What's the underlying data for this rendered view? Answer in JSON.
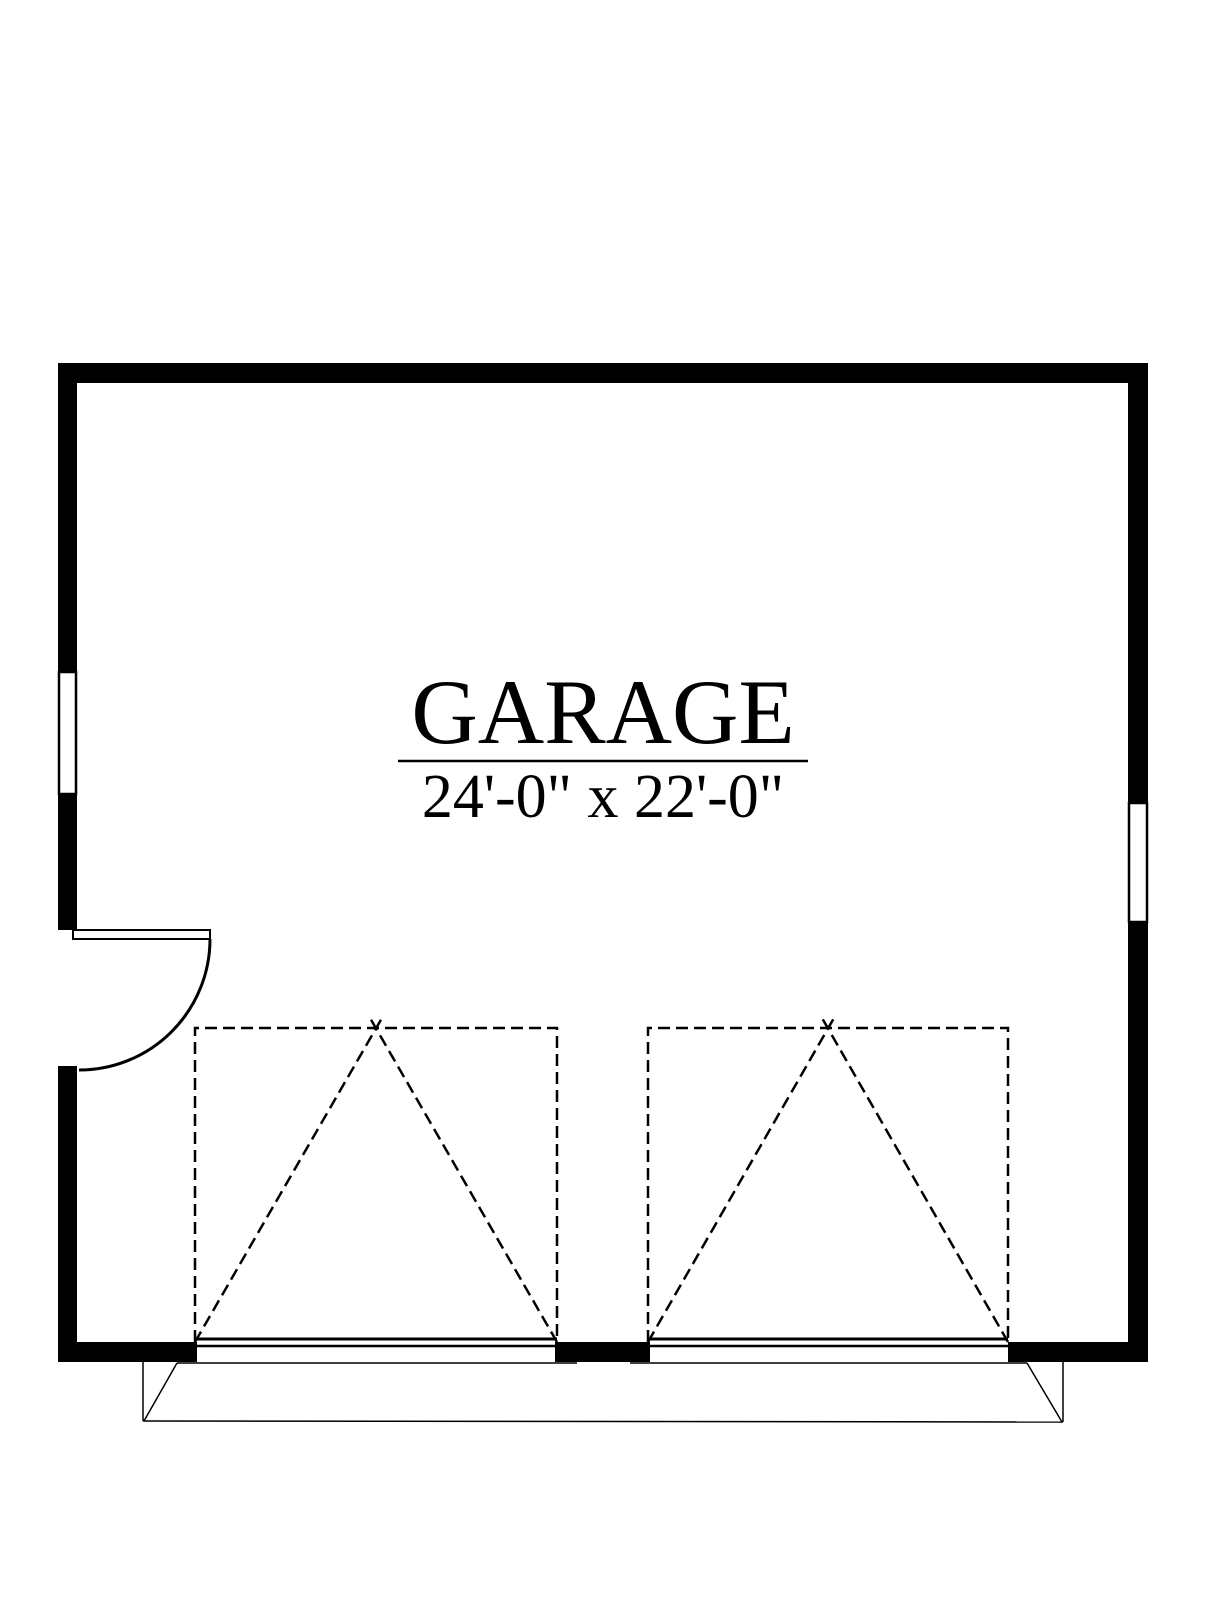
{
  "page": {
    "background_color": "#ffffff",
    "line_color": "#000000"
  },
  "floor_plan": {
    "room_label": "GARAGE",
    "room_dimensions": "24'-0\" x 22'-0\"",
    "elements": [
      "exterior-walls",
      "left-wall-window",
      "right-wall-window",
      "entry-door-with-swing-arc",
      "overhead-garage-door-left",
      "overhead-garage-door-right",
      "driveway-apron"
    ],
    "garage_door_count": 2,
    "window_count": 2,
    "entry_door_count": 1
  }
}
